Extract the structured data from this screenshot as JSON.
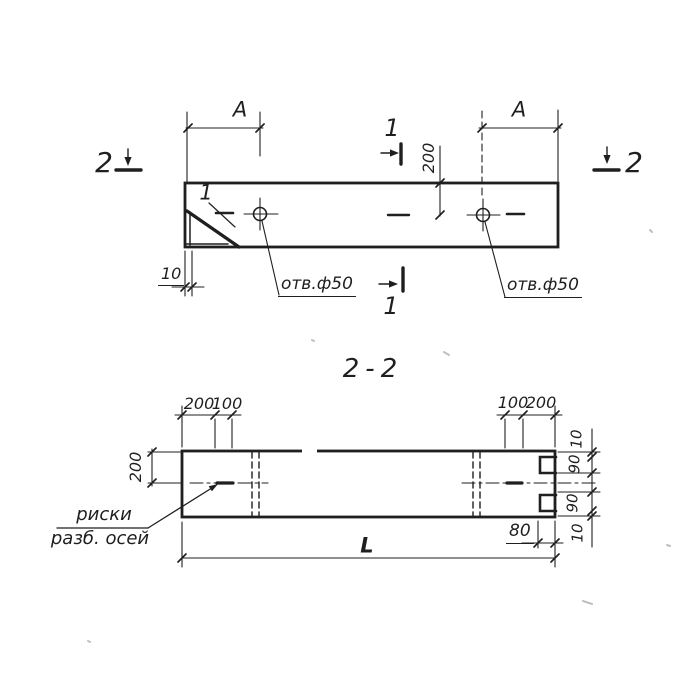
{
  "colors": {
    "ink": "#1f1f1f",
    "paper": "#ffffff"
  },
  "top_view": {
    "section_marker_2_left": "2",
    "section_marker_2_right": "2",
    "section_marker_1_top": "1",
    "section_marker_1_bottom": "1",
    "detail_mark": "1",
    "dim_A_left": "A",
    "dim_A_right": "A",
    "dim_200": "200",
    "dim_10": "10",
    "hole_left_label": "отв.ф50",
    "hole_right_label": "отв.ф50"
  },
  "section_view": {
    "title": "2-2",
    "dim_left_200": "200",
    "dim_top_left_200": "200",
    "dim_top_left_100": "100",
    "dim_top_right_100": "100",
    "dim_top_right_200": "200",
    "dim_right_10_top": "10",
    "dim_right_90_top": "90",
    "dim_right_90_bottom": "90",
    "dim_right_10_bottom": "10",
    "dim_80": "80",
    "dim_length": "L",
    "axis_marks_line1": "риски",
    "axis_marks_line2": "разб. осей"
  }
}
